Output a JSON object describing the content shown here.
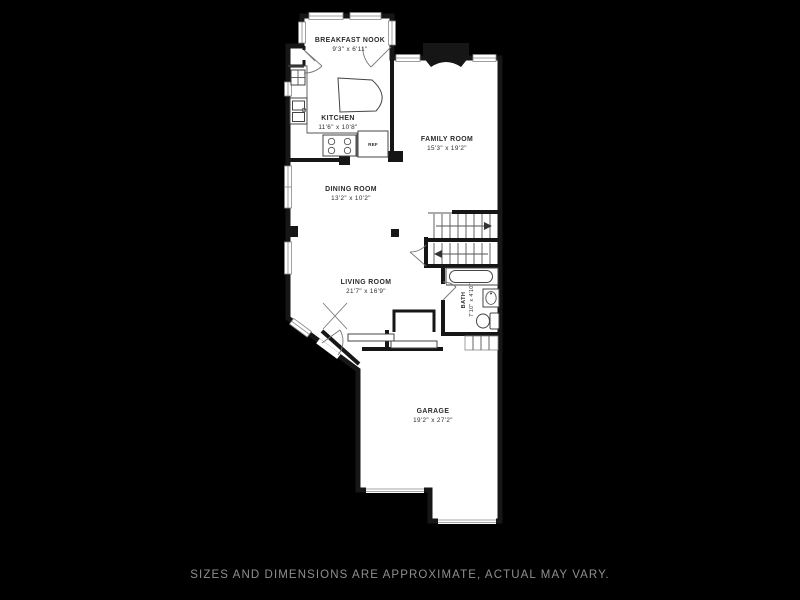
{
  "footer": {
    "caption": "SIZES AND DIMENSIONS ARE APPROXIMATE, ACTUAL MAY VARY."
  },
  "colors": {
    "background": "#000000",
    "walls": "#161616",
    "floor": "#ffffff",
    "caption_text": "#8f8f8f",
    "label_text": "#2b2b2b"
  },
  "rooms": {
    "breakfast_nook": {
      "name": "BREAKFAST NOOK",
      "dims": "9'3\" x 6'11\""
    },
    "kitchen": {
      "name": "KITCHEN",
      "dims": "11'6\" x 10'8\""
    },
    "family_room": {
      "name": "FAMILY ROOM",
      "dims": "15'3\" x 19'2\""
    },
    "dining_room": {
      "name": "DINING ROOM",
      "dims": "13'2\" x 10'2\""
    },
    "living_room": {
      "name": "LIVING ROOM",
      "dims": "21'7\" x 16'9\""
    },
    "bath": {
      "name": "BATH",
      "dims": "7'10\" x 4'10\""
    },
    "garage": {
      "name": "GARAGE",
      "dims": "19'2\" x 27'2\""
    }
  },
  "fixtures": {
    "refrigerator_label": "REF",
    "icons": [
      "fireplace-icon",
      "stove-icon",
      "refrigerator-icon",
      "kitchen-sink-icon",
      "dishwasher-icon",
      "kitchen-island",
      "bathtub-icon",
      "toilet-icon",
      "bath-sink-icon",
      "staircase",
      "garage-door",
      "front-door",
      "window",
      "closet-sliding-doors",
      "bifold-door"
    ]
  }
}
